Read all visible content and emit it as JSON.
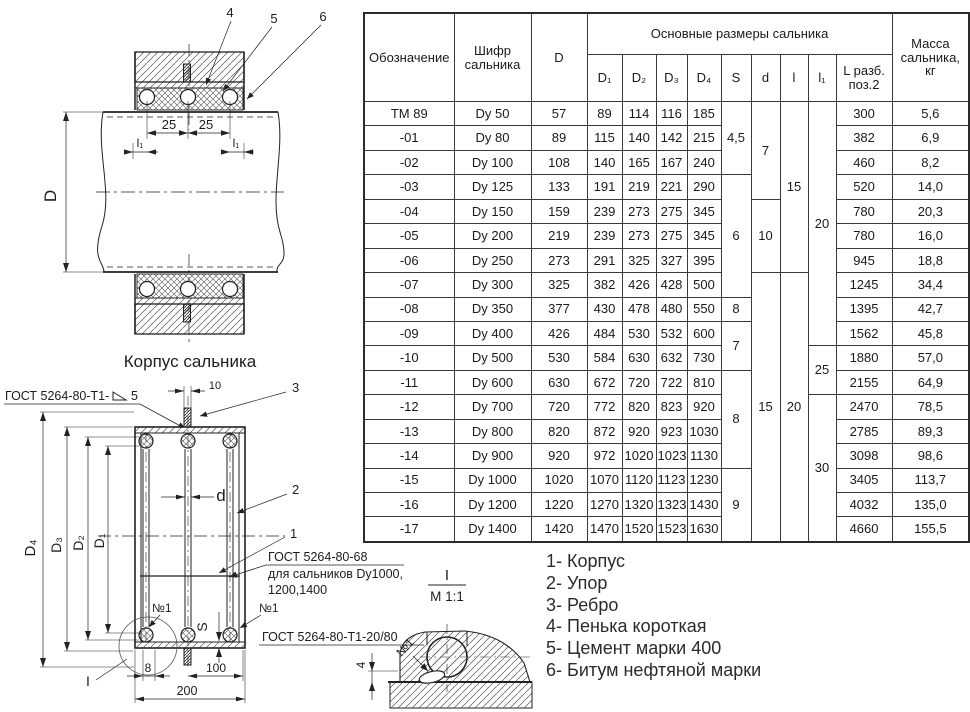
{
  "table": {
    "header": {
      "designation": "Обозначение",
      "code": "Шифр\nсальника",
      "diameter": "D",
      "group": "Основные размеры сальника",
      "sub": [
        "D₁",
        "D₂",
        "D₃",
        "D₄",
        "S",
        "d",
        "l",
        "l₁",
        "L разб.\nпоз.2"
      ],
      "mass": "Масса\nсальника,\nкг"
    },
    "rows": [
      {
        "des": "ТМ 89",
        "code": "Dy 50",
        "D": "57",
        "D1": "89",
        "D2": "114",
        "D3": "116",
        "D4": "185",
        "L": "300",
        "mass": "5,6"
      },
      {
        "des": "-01",
        "code": "Dy 80",
        "D": "89",
        "D1": "115",
        "D2": "140",
        "D3": "142",
        "D4": "215",
        "L": "382",
        "mass": "6,9"
      },
      {
        "des": "-02",
        "code": "Dy 100",
        "D": "108",
        "D1": "140",
        "D2": "165",
        "D3": "167",
        "D4": "240",
        "L": "460",
        "mass": "8,2"
      },
      {
        "des": "-03",
        "code": "Dy 125",
        "D": "133",
        "D1": "191",
        "D2": "219",
        "D3": "221",
        "D4": "290",
        "L": "520",
        "mass": "14,0"
      },
      {
        "des": "-04",
        "code": "Dy 150",
        "D": "159",
        "D1": "239",
        "D2": "273",
        "D3": "275",
        "D4": "345",
        "L": "780",
        "mass": "20,3"
      },
      {
        "des": "-05",
        "code": "Dy 200",
        "D": "219",
        "D1": "239",
        "D2": "273",
        "D3": "275",
        "D4": "345",
        "L": "780",
        "mass": "16,0"
      },
      {
        "des": "-06",
        "code": "Dy 250",
        "D": "273",
        "D1": "291",
        "D2": "325",
        "D3": "327",
        "D4": "395",
        "L": "945",
        "mass": "18,8"
      },
      {
        "des": "-07",
        "code": "Dy 300",
        "D": "325",
        "D1": "382",
        "D2": "426",
        "D3": "428",
        "D4": "500",
        "L": "1245",
        "mass": "34,4"
      },
      {
        "des": "-08",
        "code": "Dy 350",
        "D": "377",
        "D1": "430",
        "D2": "478",
        "D3": "480",
        "D4": "550",
        "L": "1395",
        "mass": "42,7"
      },
      {
        "des": "-09",
        "code": "Dy 400",
        "D": "426",
        "D1": "484",
        "D2": "530",
        "D3": "532",
        "D4": "600",
        "L": "1562",
        "mass": "45,8"
      },
      {
        "des": "-10",
        "code": "Dy 500",
        "D": "530",
        "D1": "584",
        "D2": "630",
        "D3": "632",
        "D4": "730",
        "L": "1880",
        "mass": "57,0"
      },
      {
        "des": "-11",
        "code": "Dy 600",
        "D": "630",
        "D1": "672",
        "D2": "720",
        "D3": "722",
        "D4": "810",
        "L": "2155",
        "mass": "64,9"
      },
      {
        "des": "-12",
        "code": "Dy 700",
        "D": "720",
        "D1": "772",
        "D2": "820",
        "D3": "823",
        "D4": "920",
        "L": "2470",
        "mass": "78,5"
      },
      {
        "des": "-13",
        "code": "Dy 800",
        "D": "820",
        "D1": "872",
        "D2": "920",
        "D3": "923",
        "D4": "1030",
        "L": "2785",
        "mass": "89,3"
      },
      {
        "des": "-14",
        "code": "Dy 900",
        "D": "920",
        "D1": "972",
        "D2": "1020",
        "D3": "1023",
        "D4": "1130",
        "L": "3098",
        "mass": "98,6"
      },
      {
        "des": "-15",
        "code": "Dy 1000",
        "D": "1020",
        "D1": "1070",
        "D2": "1120",
        "D3": "1123",
        "D4": "1230",
        "L": "3405",
        "mass": "113,7"
      },
      {
        "des": "-16",
        "code": "Dy 1200",
        "D": "1220",
        "D1": "1270",
        "D2": "1320",
        "D3": "1323",
        "D4": "1430",
        "L": "4032",
        "mass": "135,0"
      },
      {
        "des": "-17",
        "code": "Dy 1400",
        "D": "1420",
        "D1": "1470",
        "D2": "1520",
        "D3": "1523",
        "D4": "1630",
        "L": "4660",
        "mass": "155,5"
      }
    ],
    "merged": {
      "S": [
        {
          "v": "4,5",
          "span": 3
        },
        {
          "v": "6",
          "span": 5
        },
        {
          "v": "8",
          "span": 1
        },
        {
          "v": "7",
          "span": 2
        },
        {
          "v": "8",
          "span": 4
        },
        {
          "v": "9",
          "span": 3
        }
      ],
      "d": [
        {
          "v": "7",
          "span": 4
        },
        {
          "v": "10",
          "span": 3
        },
        {
          "v": "15",
          "span": 11
        }
      ],
      "l": [
        {
          "v": "15",
          "span": 7
        },
        {
          "v": "20",
          "span": 11
        }
      ],
      "l1": [
        {
          "v": "20",
          "span": 10
        },
        {
          "v": "25",
          "span": 2
        },
        {
          "v": "30",
          "span": 6
        }
      ]
    },
    "highlight": {
      "row_index": 13,
      "color": "#e60000"
    }
  },
  "legend": {
    "items": [
      "1- Корпус",
      "2- Упор",
      "3- Ребро",
      "4- Пенька короткая",
      "5- Цемент марки 400",
      "6- Битум нефтяной марки"
    ]
  },
  "drawings": {
    "top": {
      "caption": "Корпус сальника",
      "dim_D": "D",
      "dim_25a": "25",
      "dim_25b": "25",
      "dim_l1": "l₁",
      "callout_4": "4",
      "callout_5": "5",
      "callout_6": "6"
    },
    "bottom": {
      "gost_t1_5_prefix": "ГОСТ 5264-80-Т1-",
      "gost_t1_5_num": "5",
      "dim_10": "10",
      "callout_3": "3",
      "callout_2": "2",
      "callout_1": "1",
      "dim_d": "d",
      "dim_D4": "D₄",
      "dim_D3": "D₃",
      "dim_D2": "D₂",
      "dim_D1": "D₁",
      "gost_68_line1": "ГОСТ 5264-80-68",
      "gost_68_line2": "для сальников Dy1000,",
      "gost_68_line3": "1200,1400",
      "num1_left": "№1",
      "num1_right": "№1",
      "dim_S": "S",
      "gost_t1_2080": "ГОСТ 5264-80-Т1-20/80",
      "view_ref": "I",
      "dim_8": "8",
      "dim_100": "100",
      "dim_200": "200"
    },
    "detail": {
      "title": "I",
      "scale": "М 1:1",
      "num1": "№1",
      "dim_4": "4"
    }
  }
}
